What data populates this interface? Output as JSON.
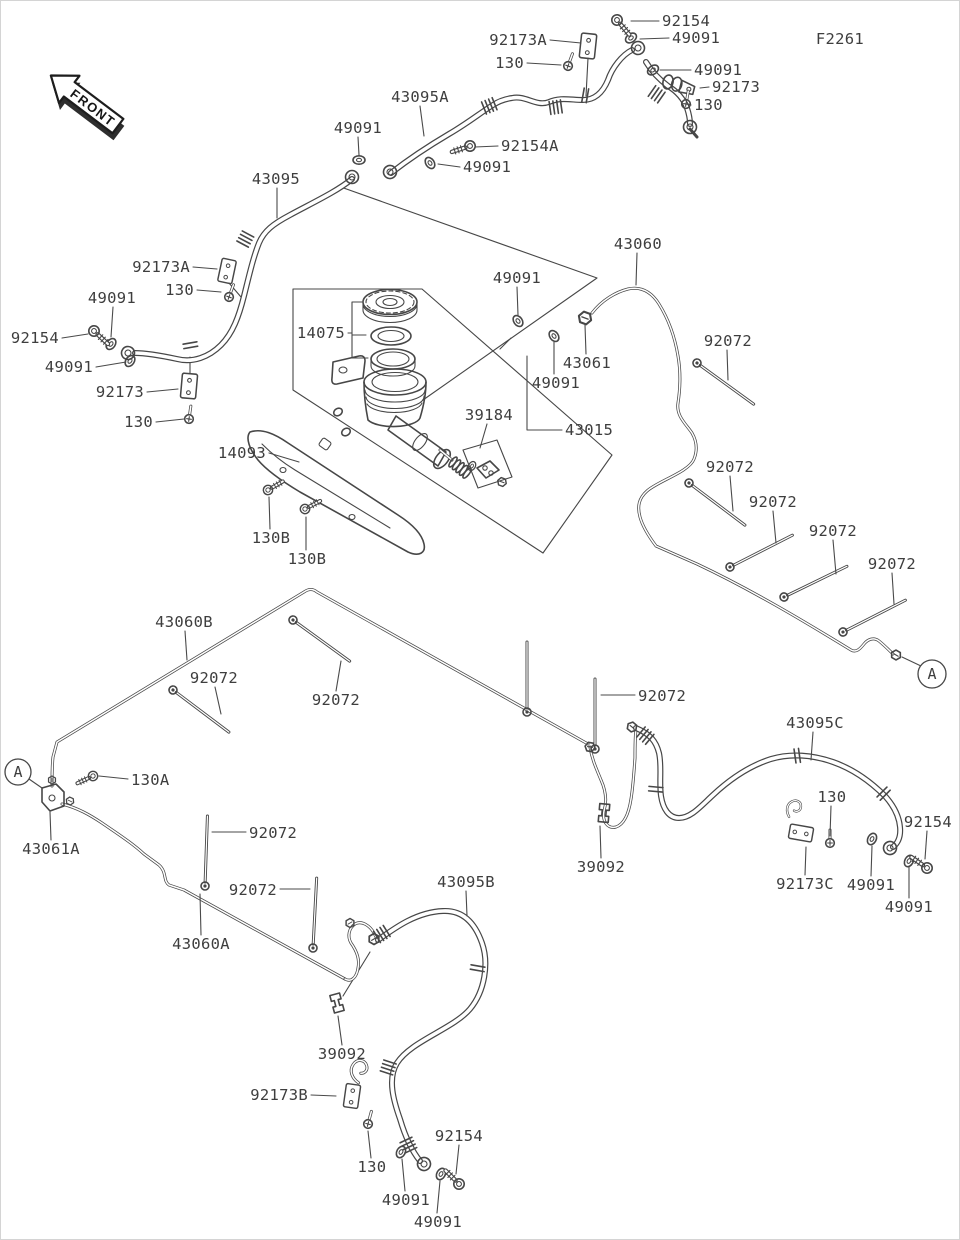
{
  "figure": {
    "code": "F2261",
    "front_label": "FRONT"
  },
  "colors": {
    "ink": "#474747",
    "label": "#3e3e3e",
    "background": "#ffffff"
  },
  "callouts": [
    {
      "text": "A",
      "cx": 18,
      "cy": 772,
      "r": 13,
      "leader": [
        [
          29,
          779
        ],
        [
          42,
          788
        ]
      ]
    },
    {
      "text": "A",
      "cx": 932,
      "cy": 674,
      "r": 14,
      "leader": [
        [
          921,
          666
        ],
        [
          902,
          657
        ]
      ]
    }
  ],
  "labels": [
    {
      "t": "F2261",
      "x": 840,
      "y": 44,
      "a": "middle"
    },
    {
      "t": "92154",
      "x": 662,
      "y": 26,
      "a": "start",
      "leader": [
        [
          659,
          21
        ],
        [
          631,
          21
        ]
      ]
    },
    {
      "t": "49091",
      "x": 672,
      "y": 43,
      "a": "start",
      "leader": [
        [
          669,
          38
        ],
        [
          640,
          39
        ]
      ]
    },
    {
      "t": "92173A",
      "x": 547,
      "y": 45,
      "a": "end",
      "leader": [
        [
          550,
          40
        ],
        [
          581,
          43
        ]
      ]
    },
    {
      "t": "130",
      "x": 524,
      "y": 68,
      "a": "end",
      "leader": [
        [
          527,
          63
        ],
        [
          561,
          65
        ]
      ]
    },
    {
      "t": "49091",
      "x": 694,
      "y": 75,
      "a": "start",
      "leader": [
        [
          691,
          70
        ],
        [
          660,
          70
        ]
      ]
    },
    {
      "t": "92173",
      "x": 712,
      "y": 92,
      "a": "start",
      "leader": [
        [
          709,
          87
        ],
        [
          700,
          88
        ]
      ]
    },
    {
      "t": "130",
      "x": 694,
      "y": 110,
      "a": "start",
      "leader": [
        [
          691,
          105
        ],
        [
          688,
          104
        ]
      ]
    },
    {
      "t": "43095A",
      "x": 420,
      "y": 102,
      "a": "middle",
      "leader": [
        [
          420,
          106
        ],
        [
          424,
          136
        ]
      ]
    },
    {
      "t": "92154A",
      "x": 501,
      "y": 151,
      "a": "start",
      "leader": [
        [
          498,
          146
        ],
        [
          475,
          147
        ]
      ]
    },
    {
      "t": "49091",
      "x": 463,
      "y": 172,
      "a": "start",
      "leader": [
        [
          460,
          167
        ],
        [
          438,
          164
        ]
      ]
    },
    {
      "t": "49091",
      "x": 358,
      "y": 133,
      "a": "middle",
      "leader": [
        [
          358,
          137
        ],
        [
          359,
          155
        ]
      ]
    },
    {
      "t": "43095",
      "x": 276,
      "y": 184,
      "a": "middle",
      "leader": [
        [
          277,
          188
        ],
        [
          277,
          218
        ]
      ]
    },
    {
      "t": "92173A",
      "x": 190,
      "y": 272,
      "a": "end",
      "leader": [
        [
          193,
          267
        ],
        [
          217,
          269
        ]
      ]
    },
    {
      "t": "130",
      "x": 194,
      "y": 295,
      "a": "end",
      "leader": [
        [
          197,
          290
        ],
        [
          221,
          292
        ]
      ]
    },
    {
      "t": "49091",
      "x": 112,
      "y": 303,
      "a": "middle",
      "leader": [
        [
          113,
          307
        ],
        [
          111,
          337
        ]
      ]
    },
    {
      "t": "92154",
      "x": 59,
      "y": 343,
      "a": "end",
      "leader": [
        [
          62,
          338
        ],
        [
          88,
          334
        ]
      ]
    },
    {
      "t": "49091",
      "x": 93,
      "y": 372,
      "a": "end",
      "leader": [
        [
          96,
          367
        ],
        [
          126,
          362
        ]
      ]
    },
    {
      "t": "92173",
      "x": 144,
      "y": 397,
      "a": "end",
      "leader": [
        [
          147,
          392
        ],
        [
          178,
          389
        ]
      ]
    },
    {
      "t": "130",
      "x": 153,
      "y": 427,
      "a": "end",
      "leader": [
        [
          156,
          422
        ],
        [
          184,
          419
        ]
      ]
    },
    {
      "t": "14093",
      "x": 266,
      "y": 458,
      "a": "end",
      "leader": [
        [
          269,
          453
        ],
        [
          299,
          462
        ]
      ]
    },
    {
      "t": "130B",
      "x": 271,
      "y": 543,
      "a": "middle",
      "leader": [
        [
          270,
          529
        ],
        [
          269,
          497
        ]
      ]
    },
    {
      "t": "130B",
      "x": 307,
      "y": 564,
      "a": "middle",
      "leader": [
        [
          306,
          550
        ],
        [
          306,
          517
        ]
      ]
    },
    {
      "t": "49091",
      "x": 517,
      "y": 283,
      "a": "middle",
      "leader": [
        [
          517,
          287
        ],
        [
          518,
          315
        ]
      ]
    },
    {
      "t": "14075",
      "x": 345,
      "y": 338,
      "a": "end",
      "leader": [
        [
          348,
          333
        ],
        [
          352,
          333
        ]
      ]
    },
    {
      "t": "43061",
      "x": 587,
      "y": 368,
      "a": "middle",
      "leader": [
        [
          586,
          354
        ],
        [
          585,
          325
        ]
      ]
    },
    {
      "t": "49091",
      "x": 556,
      "y": 388,
      "a": "middle",
      "leader": [
        [
          554,
          374
        ],
        [
          554,
          342
        ]
      ]
    },
    {
      "t": "39184",
      "x": 489,
      "y": 420,
      "a": "middle",
      "leader": [
        [
          487,
          424
        ],
        [
          480,
          448
        ]
      ]
    },
    {
      "t": "43015",
      "x": 565,
      "y": 435,
      "a": "start",
      "leader": [
        [
          562,
          430
        ],
        [
          527,
          430
        ],
        [
          527,
          356
        ]
      ]
    },
    {
      "t": "43060",
      "x": 638,
      "y": 249,
      "a": "middle",
      "leader": [
        [
          637,
          253
        ],
        [
          636,
          285
        ]
      ]
    },
    {
      "t": "92072",
      "x": 728,
      "y": 346,
      "a": "middle",
      "leader": [
        [
          727,
          350
        ],
        [
          728,
          380
        ]
      ]
    },
    {
      "t": "92072",
      "x": 730,
      "y": 472,
      "a": "middle",
      "leader": [
        [
          730,
          476
        ],
        [
          733,
          511
        ]
      ]
    },
    {
      "t": "92072",
      "x": 773,
      "y": 507,
      "a": "middle",
      "leader": [
        [
          773,
          511
        ],
        [
          776,
          543
        ]
      ]
    },
    {
      "t": "92072",
      "x": 833,
      "y": 536,
      "a": "middle",
      "leader": [
        [
          833,
          540
        ],
        [
          836,
          574
        ]
      ]
    },
    {
      "t": "92072",
      "x": 892,
      "y": 569,
      "a": "middle",
      "leader": [
        [
          892,
          573
        ],
        [
          894,
          604
        ]
      ]
    },
    {
      "t": "43060B",
      "x": 184,
      "y": 627,
      "a": "middle",
      "leader": [
        [
          185,
          631
        ],
        [
          187,
          660
        ]
      ]
    },
    {
      "t": "92072",
      "x": 214,
      "y": 683,
      "a": "middle",
      "leader": [
        [
          215,
          687
        ],
        [
          221,
          714
        ]
      ]
    },
    {
      "t": "92072",
      "x": 336,
      "y": 705,
      "a": "middle",
      "leader": [
        [
          336,
          691
        ],
        [
          341,
          661
        ]
      ]
    },
    {
      "t": "130A",
      "x": 131,
      "y": 785,
      "a": "start",
      "leader": [
        [
          128,
          779
        ],
        [
          99,
          776
        ]
      ]
    },
    {
      "t": "43061A",
      "x": 51,
      "y": 854,
      "a": "middle",
      "leader": [
        [
          51,
          840
        ],
        [
          50,
          812
        ]
      ]
    },
    {
      "t": "92072",
      "x": 249,
      "y": 838,
      "a": "start",
      "leader": [
        [
          246,
          832
        ],
        [
          212,
          832
        ]
      ]
    },
    {
      "t": "92072",
      "x": 277,
      "y": 895,
      "a": "end",
      "leader": [
        [
          280,
          889
        ],
        [
          310,
          889
        ]
      ]
    },
    {
      "t": "43060A",
      "x": 201,
      "y": 949,
      "a": "middle",
      "leader": [
        [
          201,
          935
        ],
        [
          200,
          894
        ]
      ]
    },
    {
      "t": "43095B",
      "x": 466,
      "y": 887,
      "a": "middle",
      "leader": [
        [
          466,
          891
        ],
        [
          467,
          916
        ]
      ]
    },
    {
      "t": "39092",
      "x": 342,
      "y": 1059,
      "a": "middle",
      "leader": [
        [
          342,
          1045
        ],
        [
          338,
          1016
        ]
      ]
    },
    {
      "t": "92173B",
      "x": 308,
      "y": 1100,
      "a": "end",
      "leader": [
        [
          311,
          1095
        ],
        [
          336,
          1096
        ]
      ]
    },
    {
      "t": "130",
      "x": 372,
      "y": 1172,
      "a": "middle",
      "leader": [
        [
          371,
          1158
        ],
        [
          368,
          1131
        ]
      ]
    },
    {
      "t": "92154",
      "x": 459,
      "y": 1141,
      "a": "middle",
      "leader": [
        [
          459,
          1145
        ],
        [
          456,
          1174
        ]
      ]
    },
    {
      "t": "49091",
      "x": 406,
      "y": 1205,
      "a": "middle",
      "leader": [
        [
          405,
          1191
        ],
        [
          402,
          1159
        ]
      ]
    },
    {
      "t": "49091",
      "x": 438,
      "y": 1227,
      "a": "middle",
      "leader": [
        [
          437,
          1213
        ],
        [
          440,
          1181
        ]
      ]
    },
    {
      "t": "92072",
      "x": 638,
      "y": 701,
      "a": "start",
      "leader": [
        [
          635,
          695
        ],
        [
          601,
          695
        ]
      ]
    },
    {
      "t": "43095C",
      "x": 815,
      "y": 728,
      "a": "middle",
      "leader": [
        [
          813,
          732
        ],
        [
          811,
          760
        ]
      ]
    },
    {
      "t": "130",
      "x": 832,
      "y": 802,
      "a": "middle",
      "leader": [
        [
          831,
          806
        ],
        [
          830,
          836
        ]
      ]
    },
    {
      "t": "92154",
      "x": 928,
      "y": 827,
      "a": "middle",
      "leader": [
        [
          927,
          831
        ],
        [
          925,
          859
        ]
      ]
    },
    {
      "t": "39092",
      "x": 601,
      "y": 872,
      "a": "middle",
      "leader": [
        [
          601,
          858
        ],
        [
          600,
          826
        ]
      ]
    },
    {
      "t": "92173C",
      "x": 805,
      "y": 889,
      "a": "middle",
      "leader": [
        [
          805,
          875
        ],
        [
          806,
          847
        ]
      ]
    },
    {
      "t": "49091",
      "x": 871,
      "y": 890,
      "a": "middle",
      "leader": [
        [
          871,
          876
        ],
        [
          872,
          846
        ]
      ]
    },
    {
      "t": "49091",
      "x": 909,
      "y": 912,
      "a": "middle",
      "leader": [
        [
          909,
          898
        ],
        [
          909,
          867
        ]
      ]
    }
  ]
}
